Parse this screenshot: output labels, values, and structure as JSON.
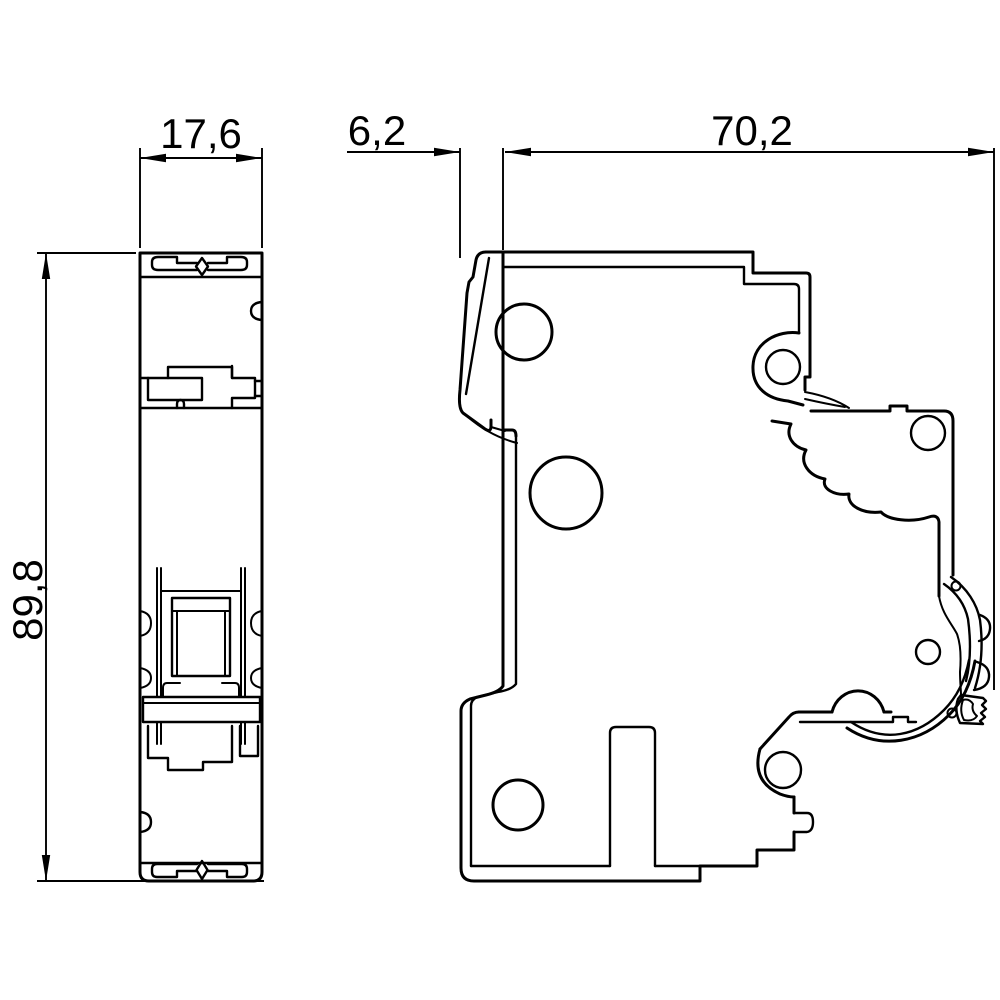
{
  "drawing": {
    "kind": "technical-dimension-drawing",
    "subject": "din-rail-circuit-breaker",
    "style": {
      "line_color": "#000000",
      "background_color": "#ffffff"
    },
    "views": {
      "front_view": {
        "name": "front view"
      },
      "side_view": {
        "name": "side view"
      }
    },
    "dimensions": [
      {
        "id": "width",
        "value": "17,6",
        "orientation": "horizontal",
        "view": "front"
      },
      {
        "id": "handle-projection",
        "value": "6,2",
        "orientation": "horizontal",
        "view": "side"
      },
      {
        "id": "depth",
        "value": "70,2",
        "orientation": "horizontal",
        "view": "side"
      },
      {
        "id": "height",
        "value": "89,8",
        "orientation": "vertical",
        "view": "front"
      }
    ]
  }
}
